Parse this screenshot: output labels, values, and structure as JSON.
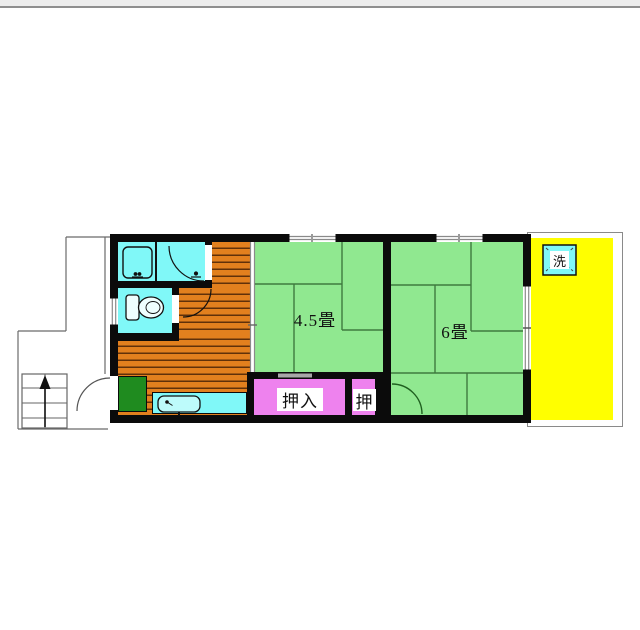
{
  "plan": {
    "labels": {
      "room_4_5": "4.5畳",
      "room_6": "6畳",
      "closet_large": "押入",
      "closet_small": "押",
      "laundry": "洗"
    },
    "colors": {
      "tatami_green": "#90E890",
      "wood_floor_orange": "#E2801E",
      "water_area_cyan": "#80F8F8",
      "closet_pink": "#EE82EE",
      "balcony_yellow": "#FFFF00",
      "genkan_mat_green": "#1F8B1F",
      "wall_black": "#0B0B0B"
    }
  }
}
